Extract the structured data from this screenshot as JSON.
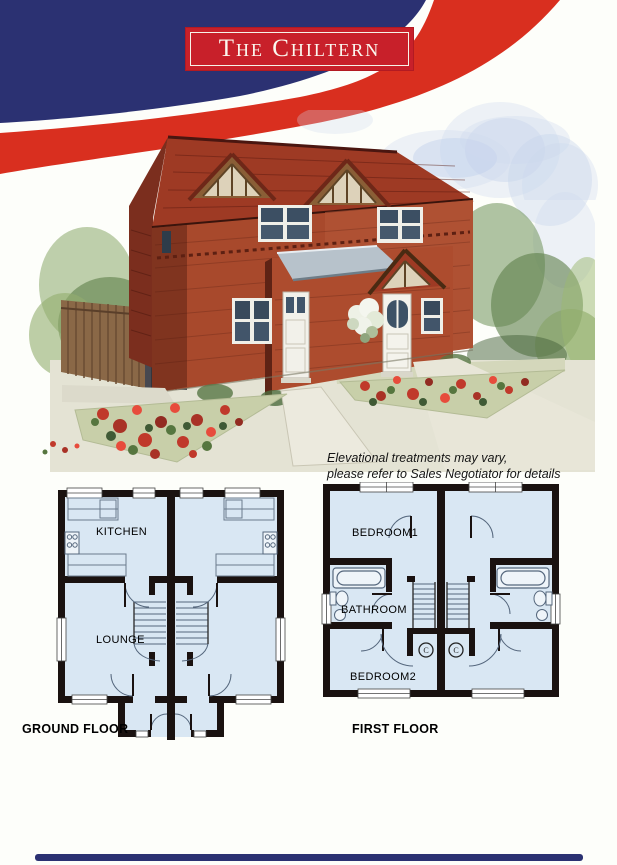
{
  "header": {
    "title": "The Chiltern"
  },
  "illustration": {
    "disclaimer_line1": "Elevational treatments may vary,",
    "disclaimer_line2": "please refer to Sales Negotiator for details"
  },
  "floorplans": {
    "ground": {
      "caption": "GROUND FLOOR",
      "kitchen_label": "KITCHEN",
      "lounge_label": "LOUNGE"
    },
    "first": {
      "caption": "FIRST FLOOR",
      "bedroom1_label": "BEDROOM1",
      "bathroom_label": "BATHROOM",
      "bedroom2_label": "BEDROOM2",
      "cupboard_label": "C"
    }
  },
  "colors": {
    "navy": "#2b3172",
    "red_band": "#d92f1f",
    "title_box_red": "#c8202a",
    "plan_floor": "#d9e7f3",
    "plan_wall": "#1a1210",
    "brick": "#a8492c"
  }
}
